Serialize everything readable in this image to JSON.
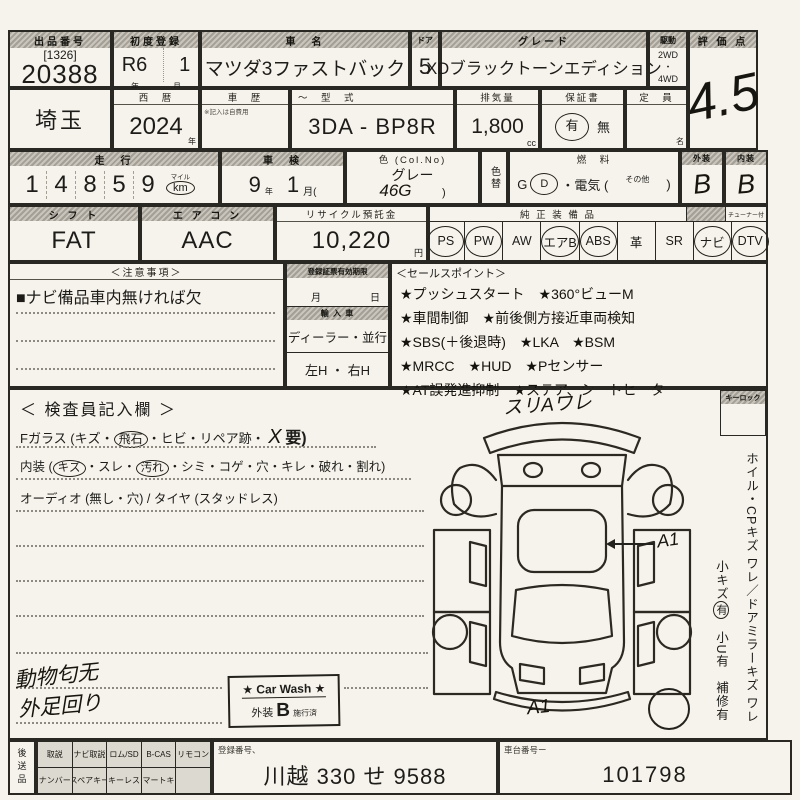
{
  "row1": {
    "lot_header": "出品番号",
    "lot_bracket": "[1326]",
    "lot_number": "20388",
    "reg_header": "初度登録",
    "reg_era": "R6",
    "reg_month": "1",
    "reg_year_unit": "年",
    "reg_month_unit": "月",
    "name_header": "車　名",
    "car_name": "マツダ3ファストバック",
    "doors_header": "ドア",
    "doors": "5",
    "grade_header": "グレード",
    "grade": "XDブラックトーンエディション",
    "drive_header": "駆動",
    "drive_top": "2WD",
    "drive_mid": "・",
    "drive_bottom": "4WD",
    "score_header": "評 価 点",
    "score": "4.5"
  },
  "row2": {
    "prefecture": "埼玉",
    "year_header": "西　暦",
    "year": "2024",
    "year_unit": "年",
    "history_header": "車　歴",
    "history_note": "※記入は自費用",
    "model_header": "～　型　式",
    "model": "3DA - BP8R",
    "disp_header": "排気量",
    "displacement": "1,800",
    "disp_unit": "cc",
    "warranty_header": "保証書",
    "warranty_yes": "有",
    "warranty_no": "無",
    "capacity_header": "定　員",
    "capacity_unit": "名"
  },
  "row3": {
    "mileage_header": "走　行",
    "mileage_digits": [
      "1",
      "4",
      "8",
      "5",
      "9"
    ],
    "mile_label": "マイル",
    "km_label": "km",
    "inspection_header": "車　検",
    "insp_year": "9",
    "insp_year_unit": "年",
    "insp_month": "1",
    "insp_month_unit": "月(",
    "color_header": "色 (Col.No)",
    "color_name": "グレー",
    "color_code": "46G",
    "color_close": ")",
    "color_change": "色替",
    "fuel_header": "燃　料",
    "fuel_g": "G",
    "fuel_d": "D",
    "fuel_elec": "・電気 (",
    "fuel_other": "その他",
    "fuel_close": ")",
    "exterior_header": "外装",
    "exterior_grade": "B",
    "interior_header": "内装",
    "interior_grade": "B"
  },
  "row4": {
    "shift_header": "シ フ ト",
    "shift": "FAT",
    "ac_header": "エ ア コ ン",
    "ac": "AAC",
    "recycle_header": "リサイクル預託金",
    "recycle": "10,220",
    "recycle_unit": "円",
    "equip_header": "純 正 装 備 品",
    "tuner_note": "チューナー付",
    "equipment": [
      {
        "label": "PS",
        "circled": true
      },
      {
        "label": "PW",
        "circled": true
      },
      {
        "label": "AW",
        "circled": false
      },
      {
        "label": "エアB",
        "circled": true
      },
      {
        "label": "ABS",
        "circled": true
      },
      {
        "label": "革",
        "circled": false
      },
      {
        "label": "SR",
        "circled": false
      },
      {
        "label": "ナビ",
        "circled": true
      },
      {
        "label": "DTV",
        "circled": true
      }
    ]
  },
  "notes": {
    "header": "＜注意事項＞",
    "line1": "■ナビ備品車内無ければ欠"
  },
  "middle": {
    "validity_header": "登録証票有効期限",
    "month_label": "月",
    "day_label": "日",
    "import_header": "輸 入 車",
    "import_value": "ディーラー・並行",
    "handle_value": "左H ・ 右H"
  },
  "sales": {
    "header": "＜セールスポイント＞",
    "lines": [
      "★プッシュスタート　★360°ビューM",
      "★車間制御　★前後側方接近車両検知",
      "★SBS(＋後退時)　★LKA　★BSM",
      "★MRCC　★HUD　★Pセンサー",
      "★AT誤発進抑制　★ステア、シートヒーター"
    ]
  },
  "inspector": {
    "header": "＜ 検査員記入欄 ＞",
    "l1_pre": "Fガラス (キズ・",
    "l1_circle": "飛石",
    "l1_mid": "・ヒビ・リペア跡・",
    "l1_x": "X",
    "l1_end": "要)",
    "l2_pre": "内装 (",
    "l2_circle1": "キズ",
    "l2_mid1": "・スレ・",
    "l2_circle2": "汚れ",
    "l2_end": "・シミ・コゲ・穴・キレ・破れ・割れ)",
    "l3": "オーディオ (無し・穴) / タイヤ (スタッドレス)",
    "hand_line1": "動物匂无",
    "hand_line2": "外足回り"
  },
  "carwash": {
    "title": "★ Car Wash ★",
    "ext_label": "外装",
    "grade": "B",
    "status": "施行済"
  },
  "diagram": {
    "annot_top": "スリAワレ",
    "annot_right": "A1",
    "annot_bottom": "A1"
  },
  "keylock_header": "キーロック",
  "sidebar": {
    "line1": "ホイル・CPキズ ワレ／ドアミラーキズ ワレ",
    "small1": "小キズ",
    "small1_mark": "有",
    "small2": "小U有",
    "small3": "補修有"
  },
  "bottom": {
    "later_label": "後送品",
    "row1": [
      "取説",
      "ナビ取説",
      "ロム/SD",
      "B-CAS",
      "リモコン"
    ],
    "row2": [
      "ナンバー",
      "スペアキー",
      "キーレス",
      "スマートキー",
      ""
    ],
    "regno_header": "登録番号、",
    "regno": "川越 330 せ 9588",
    "chassis_header": "車台番号ー",
    "chassis": "101798"
  }
}
